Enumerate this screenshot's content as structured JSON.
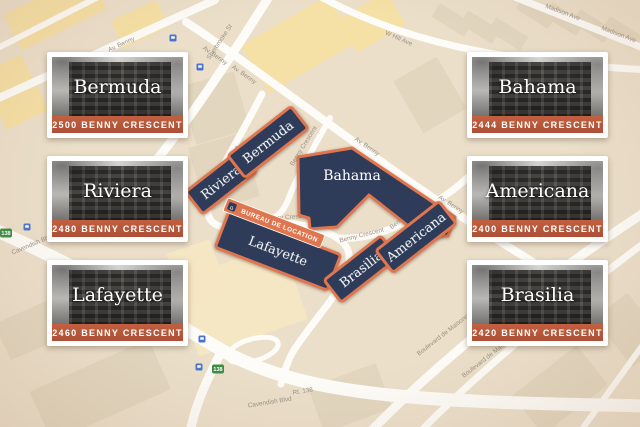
{
  "colors": {
    "building_fill": "#2e3c59",
    "building_border": "#e0764f",
    "office_banner": "#e0764f",
    "card_address_bg": "#bb5a3c",
    "map_background": "#ebdfca",
    "road": "#ffffff",
    "block_tan": "#e2d5be",
    "block_yellow": "#f6dfa2",
    "route_shield_green": "#3d8c44",
    "transit_blue": "#4a74c9"
  },
  "cards": [
    {
      "name": "Bermuda",
      "address": "2500 BENNY CRESCENT"
    },
    {
      "name": "Riviera",
      "address": "2480 BENNY CRESCENT"
    },
    {
      "name": "Lafayette",
      "address": "2460 BENNY CRESCENT"
    },
    {
      "name": "Bahama",
      "address": "2444 BENNY CRESCENT"
    },
    {
      "name": "Americana",
      "address": "2400 BENNY CRESCENT"
    },
    {
      "name": "Brasilia",
      "address": "2420 BENNY CRESCENT"
    }
  ],
  "map": {
    "buildings": [
      {
        "name": "Riviera"
      },
      {
        "name": "Bermuda"
      },
      {
        "name": "Bahama"
      },
      {
        "name": "Lafayette"
      },
      {
        "name": "Brasilia"
      },
      {
        "name": "Americana"
      }
    ],
    "rental_office_label": "BUREAU DE LOCATION",
    "route_shield": "138",
    "street_labels": [
      "Av. Benny",
      "Sherbrooke St",
      "Benny Crescent",
      "Madison Ave",
      "W Hill Ave",
      "Cavendish Blvd",
      "Rt. 138",
      "Boulevard de Maisonneuve O"
    ]
  }
}
